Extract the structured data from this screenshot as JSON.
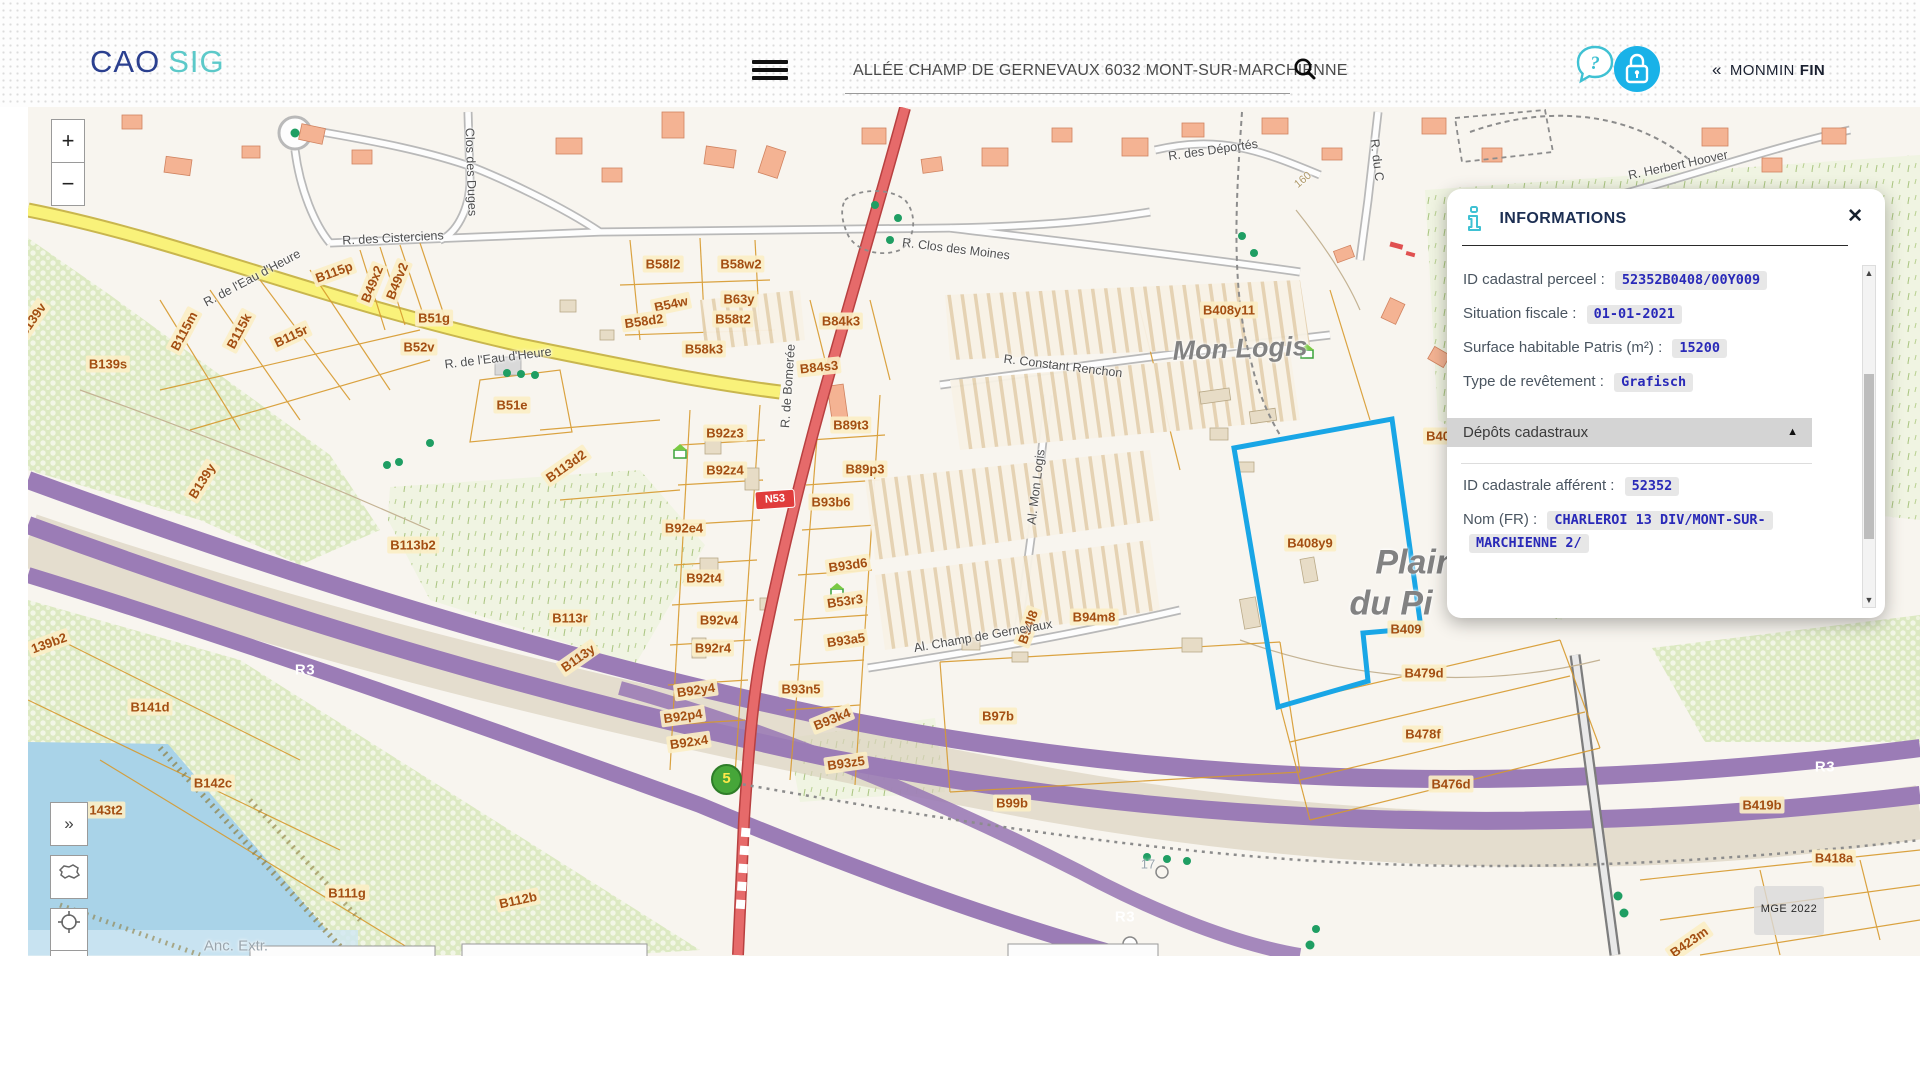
{
  "header": {
    "logo_primary": "CAO",
    "logo_accent": "SIG",
    "search_value": "ALLÉE CHAMP DE GERNEVAUX  6032 MONT-SUR-MARCHIENNE",
    "collapse_glyph": "«",
    "user_label": "MONMIN",
    "user_label_bold": "FIN",
    "icons": [
      "menu-icon",
      "search-icon",
      "help-bubble-icon",
      "lock-icon"
    ]
  },
  "panel": {
    "title": "INFORMATIONS",
    "close_glyph": "✕",
    "icon": "info-icon",
    "fields_top": [
      {
        "label": "ID cadastral perceel",
        "value": "52352B0408/00Y009"
      },
      {
        "label": "Situation fiscale",
        "value": "01-01-2021"
      },
      {
        "label": "Surface habitable Patris (m²)",
        "value": "15200"
      },
      {
        "label": "Type de revêtement",
        "value": "Grafisch"
      }
    ],
    "section_header": {
      "label": "Dépôts cadastraux",
      "collapse_glyph": "▲"
    },
    "fields_bottom": [
      {
        "label": "ID cadastrale afférent",
        "value": "52352"
      },
      {
        "label": "Nom (FR)",
        "value": "CHARLEROI 13 DIV/MONT-SUR-MARCHIENNE 2/"
      }
    ],
    "scrollbar": {
      "up_glyph": "▲",
      "down_glyph": "▼"
    }
  },
  "map": {
    "controls": {
      "zoom_in": "+",
      "zoom_out": "−",
      "expand": "»",
      "side_icons": [
        "expand-panel-icon",
        "belgium-region-icon",
        "locate-icon"
      ]
    },
    "badges": {
      "n53": "N53",
      "junction": "5",
      "marker17": "17"
    },
    "watermark": "MGE 2022",
    "colors": {
      "highlight": "#19a6e6",
      "motorway": "#9b7cb6",
      "road_red": "#e66a6a",
      "road_yellow": "#f9f27a",
      "parcel_line": "#d79a2e",
      "accent_teal": "#3fc1d3",
      "lock_blue": "#19b2e8",
      "value_blue": "#2929b8"
    },
    "road_shields": [
      {
        "text": "R3",
        "x": 305,
        "y": 670
      },
      {
        "text": "R3",
        "x": 1125,
        "y": 917
      },
      {
        "text": "R3",
        "x": 1825,
        "y": 767
      }
    ],
    "parcel_labels": [
      {
        "text": "B139v",
        "x": 32,
        "y": 320,
        "rot": -55
      },
      {
        "text": "B139s",
        "x": 108,
        "y": 364
      },
      {
        "text": "B115m",
        "x": 184,
        "y": 331,
        "rot": -62
      },
      {
        "text": "B115k",
        "x": 239,
        "y": 331,
        "rot": -62
      },
      {
        "text": "B115r",
        "x": 291,
        "y": 336,
        "rot": -25
      },
      {
        "text": "B115p",
        "x": 334,
        "y": 272,
        "rot": -20
      },
      {
        "text": "B49x2",
        "x": 372,
        "y": 284,
        "rot": -68
      },
      {
        "text": "B49v2",
        "x": 397,
        "y": 281,
        "rot": -68
      },
      {
        "text": "B51g",
        "x": 434,
        "y": 318
      },
      {
        "text": "B52v",
        "x": 419,
        "y": 347
      },
      {
        "text": "B58l2",
        "x": 663,
        "y": 264
      },
      {
        "text": "B58w2",
        "x": 741,
        "y": 264
      },
      {
        "text": "B54w",
        "x": 671,
        "y": 304,
        "rot": -12
      },
      {
        "text": "B63y",
        "x": 739,
        "y": 299
      },
      {
        "text": "B58d2",
        "x": 644,
        "y": 321,
        "rot": -8
      },
      {
        "text": "B58t2",
        "x": 733,
        "y": 319
      },
      {
        "text": "B58k3",
        "x": 704,
        "y": 349
      },
      {
        "text": "B84k3",
        "x": 841,
        "y": 321
      },
      {
        "text": "B84s3",
        "x": 819,
        "y": 367,
        "rot": -6
      },
      {
        "text": "B51e",
        "x": 512,
        "y": 405
      },
      {
        "text": "B139y",
        "x": 202,
        "y": 481,
        "rot": -58
      },
      {
        "text": "B113d2",
        "x": 566,
        "y": 466,
        "rot": -35
      },
      {
        "text": "B92z3",
        "x": 725,
        "y": 433
      },
      {
        "text": "B92z4",
        "x": 725,
        "y": 470
      },
      {
        "text": "B113b2",
        "x": 413,
        "y": 545
      },
      {
        "text": "B92e4",
        "x": 684,
        "y": 528
      },
      {
        "text": "B89t3",
        "x": 851,
        "y": 425
      },
      {
        "text": "B89p3",
        "x": 865,
        "y": 469
      },
      {
        "text": "B93b6",
        "x": 831,
        "y": 502
      },
      {
        "text": "B92t4",
        "x": 704,
        "y": 578
      },
      {
        "text": "B92v4",
        "x": 719,
        "y": 620
      },
      {
        "text": "B92r4",
        "x": 713,
        "y": 648
      },
      {
        "text": "B113r",
        "x": 570,
        "y": 618
      },
      {
        "text": "B113y",
        "x": 578,
        "y": 658,
        "rot": -35
      },
      {
        "text": "B92y4",
        "x": 696,
        "y": 690,
        "rot": -8
      },
      {
        "text": "B92p4",
        "x": 683,
        "y": 716,
        "rot": -8
      },
      {
        "text": "B92x4",
        "x": 689,
        "y": 742,
        "rot": -8
      },
      {
        "text": "B93d6",
        "x": 848,
        "y": 565,
        "rot": -8
      },
      {
        "text": "B53r3",
        "x": 845,
        "y": 601,
        "rot": -8
      },
      {
        "text": "B93a5",
        "x": 846,
        "y": 640,
        "rot": -8
      },
      {
        "text": "B93n5",
        "x": 801,
        "y": 689
      },
      {
        "text": "B93k4",
        "x": 832,
        "y": 719,
        "rot": -22
      },
      {
        "text": "B93z5",
        "x": 846,
        "y": 763,
        "rot": -8
      },
      {
        "text": "B97b",
        "x": 998,
        "y": 716
      },
      {
        "text": "B99b",
        "x": 1012,
        "y": 803
      },
      {
        "text": "B94l8",
        "x": 1028,
        "y": 627,
        "rot": -70
      },
      {
        "text": "B94m8",
        "x": 1094,
        "y": 617
      },
      {
        "text": "B408y11",
        "x": 1229,
        "y": 310
      },
      {
        "text": "B408y9",
        "x": 1310,
        "y": 543
      },
      {
        "text": "B40",
        "x": 1438,
        "y": 436
      },
      {
        "text": "B409",
        "x": 1406,
        "y": 629
      },
      {
        "text": "B479d",
        "x": 1424,
        "y": 673
      },
      {
        "text": "B478f",
        "x": 1423,
        "y": 734
      },
      {
        "text": "B476d",
        "x": 1451,
        "y": 784
      },
      {
        "text": "B418a",
        "x": 1834,
        "y": 858
      },
      {
        "text": "B423m",
        "x": 1689,
        "y": 942,
        "rot": -35
      },
      {
        "text": "B419b",
        "x": 1762,
        "y": 805
      },
      {
        "text": "B141d",
        "x": 150,
        "y": 707
      },
      {
        "text": "B142c",
        "x": 213,
        "y": 783
      },
      {
        "text": "143t2",
        "x": 106,
        "y": 810
      },
      {
        "text": "B111g",
        "x": 347,
        "y": 893
      },
      {
        "text": "B112b",
        "x": 518,
        "y": 900,
        "rot": -12
      },
      {
        "text": "139b2",
        "x": 49,
        "y": 643,
        "rot": -20
      }
    ],
    "street_labels": [
      {
        "text": "R. des Cisterciens",
        "x": 393,
        "y": 238,
        "rot": -3
      },
      {
        "text": "Clos des Duges",
        "x": 471,
        "y": 172,
        "rot": 88
      },
      {
        "text": "R. de l'Eau d'Heure",
        "x": 252,
        "y": 278,
        "rot": -28
      },
      {
        "text": "R. de l'Eau d'Heure",
        "x": 498,
        "y": 358,
        "rot": -7
      },
      {
        "text": "R. de Bomerée",
        "x": 788,
        "y": 386,
        "rot": -86
      },
      {
        "text": "R. Clos des Moines",
        "x": 956,
        "y": 249,
        "rot": 7
      },
      {
        "text": "R. des Déportés",
        "x": 1213,
        "y": 150,
        "rot": -8
      },
      {
        "text": "R. Herbert Hoover",
        "x": 1678,
        "y": 165,
        "rot": -12
      },
      {
        "text": "R. du C",
        "x": 1377,
        "y": 160,
        "rot": 83
      },
      {
        "text": "R. Constant Renchon",
        "x": 1063,
        "y": 366,
        "rot": 7
      },
      {
        "text": "Al. Mon Logis",
        "x": 1036,
        "y": 487,
        "rot": -83
      },
      {
        "text": "Al. Champ de Gernevaux",
        "x": 983,
        "y": 636,
        "rot": -10
      },
      {
        "text": "160",
        "x": 1303,
        "y": 180,
        "rot": -40,
        "cls": "contour"
      }
    ],
    "area_labels": [
      {
        "text": "Mon Logis",
        "x": 1240,
        "y": 349,
        "rot": -2,
        "size": 27
      },
      {
        "text": "Plain",
        "x": 1416,
        "y": 563,
        "size": 34
      },
      {
        "text": "du Pi",
        "x": 1391,
        "y": 604,
        "size": 34
      },
      {
        "text": "Anc. Extr.",
        "x": 236,
        "y": 946,
        "size": 15,
        "cls": "plain-txt"
      },
      {
        "text": "17",
        "x": 1148,
        "y": 864,
        "size": 13,
        "cls": "plain-txt"
      }
    ]
  }
}
